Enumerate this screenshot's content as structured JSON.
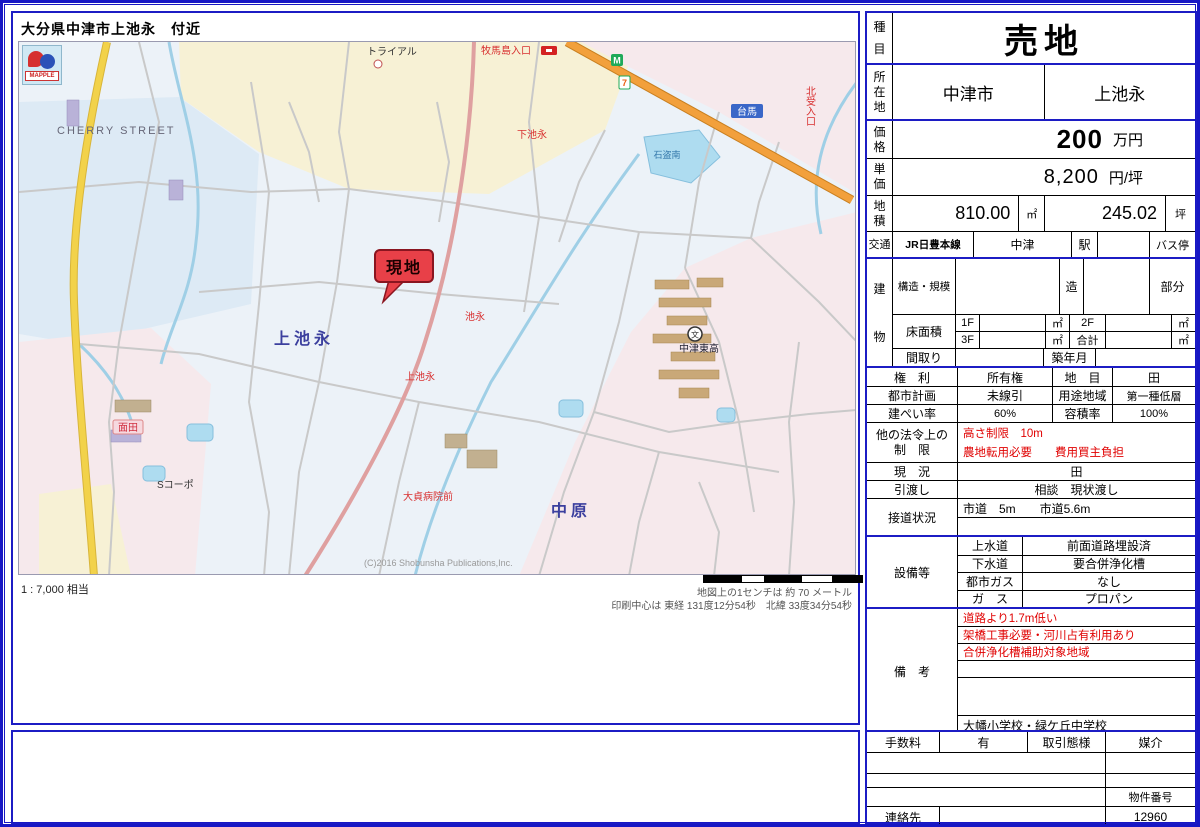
{
  "page": {
    "title": "大分県中津市上池永　付近"
  },
  "map": {
    "logo_text": "MAPPLE",
    "scale_ratio": "1 : 7,000 相当",
    "scale_note": "地図上の1センチは 約 70 メートル",
    "center_note": "印刷中心は 東経 131度12分54秒　北緯 33度34分54秒",
    "copyright": "(C)2016 Shobunsha Publications,Inc.",
    "labels": {
      "cherry_street": "CHERRY STREET",
      "trial": "トライアル",
      "makijima_bus": "牧馬島入口",
      "shimo_ikenaga_bus": "下池永",
      "daiba": "台馬",
      "kita_iriguchi": "北受入口",
      "pond": "石盗南",
      "kami_ikenaga_area": "上池永",
      "ikenaga_bus": "池永",
      "site_marker": "現地",
      "school": "中津東高",
      "nakahara_area": "中原",
      "kami_ikenaga_bus": "上池永",
      "byoin_bus": "大貞病院前",
      "s_corp": "Sコーポ",
      "menda_bus": "面田",
      "conv_m": "M",
      "conv_7": "7"
    }
  },
  "table": {
    "category": {
      "label": "種目",
      "value": "売地"
    },
    "location": {
      "label": "所在地",
      "city": "中津市",
      "district": "上池永"
    },
    "price": {
      "label": "価格",
      "value": "200",
      "unit": "万円"
    },
    "unit_price": {
      "label": "単価",
      "value": "8,200",
      "unit": "円/坪"
    },
    "land_area": {
      "label": "地積",
      "sqm": "810.00",
      "sqm_unit": "㎡",
      "tsubo": "245.02",
      "tsubo_unit": "坪"
    },
    "transport": {
      "label": "交通",
      "line": "JR日豊本線",
      "station": "中津",
      "station_suffix": "駅",
      "bus_stop": "バス停"
    },
    "building": {
      "label": "建物",
      "structure_label": "構造・規模",
      "structure_suffix": "造",
      "part_label": "部分",
      "floor_area_label": "床面積",
      "f1": "1F",
      "f2": "2F",
      "f3": "3F",
      "total_label": "合計",
      "sqm": "㎡",
      "layout_label": "間取り",
      "built_label": "築年月"
    },
    "rights": {
      "label": "権　利",
      "value": "所有権",
      "land_cat_label": "地　目",
      "land_cat": "田"
    },
    "city_plan": {
      "label": "都市計画",
      "value": "未線引",
      "zoning_label": "用途地域",
      "zoning": "第一種低層"
    },
    "coverage": {
      "label": "建ぺい率",
      "value": "60%",
      "far_label": "容積率",
      "far": "100%"
    },
    "restrictions": {
      "label_line1": "他の法令上の",
      "label_line2": "制　限",
      "line1": "高さ制限　10m",
      "line2": "農地転用必要　　費用買主負担"
    },
    "current_state": {
      "label": "現　況",
      "value": "田"
    },
    "handover": {
      "label": "引渡し",
      "value": "相談　現状渡し"
    },
    "road_access": {
      "label": "接道状況",
      "value": "市道　5m　　市道5.6m"
    },
    "facilities": {
      "label": "設備等",
      "rows": [
        {
          "name": "上水道",
          "value": "前面道路埋設済"
        },
        {
          "name": "下水道",
          "value": "要合併浄化槽"
        },
        {
          "name": "都市ガス",
          "value": "なし"
        },
        {
          "name": "ガ　ス",
          "value": "プロパン"
        }
      ]
    },
    "remarks": {
      "label": "備　考",
      "red_lines": [
        "道路より1.7m低い",
        "架橋工事必要・河川占有利用あり",
        "合併浄化槽補助対象地域"
      ],
      "schools": "大幡小学校・緑ケ丘中学校"
    },
    "footer": {
      "fee_label": "手数料",
      "fee": "有",
      "deal_label": "取引態様",
      "deal": "媒介",
      "property_no_label": "物件番号",
      "property_no": "12960",
      "contact_label": "連絡先"
    }
  }
}
